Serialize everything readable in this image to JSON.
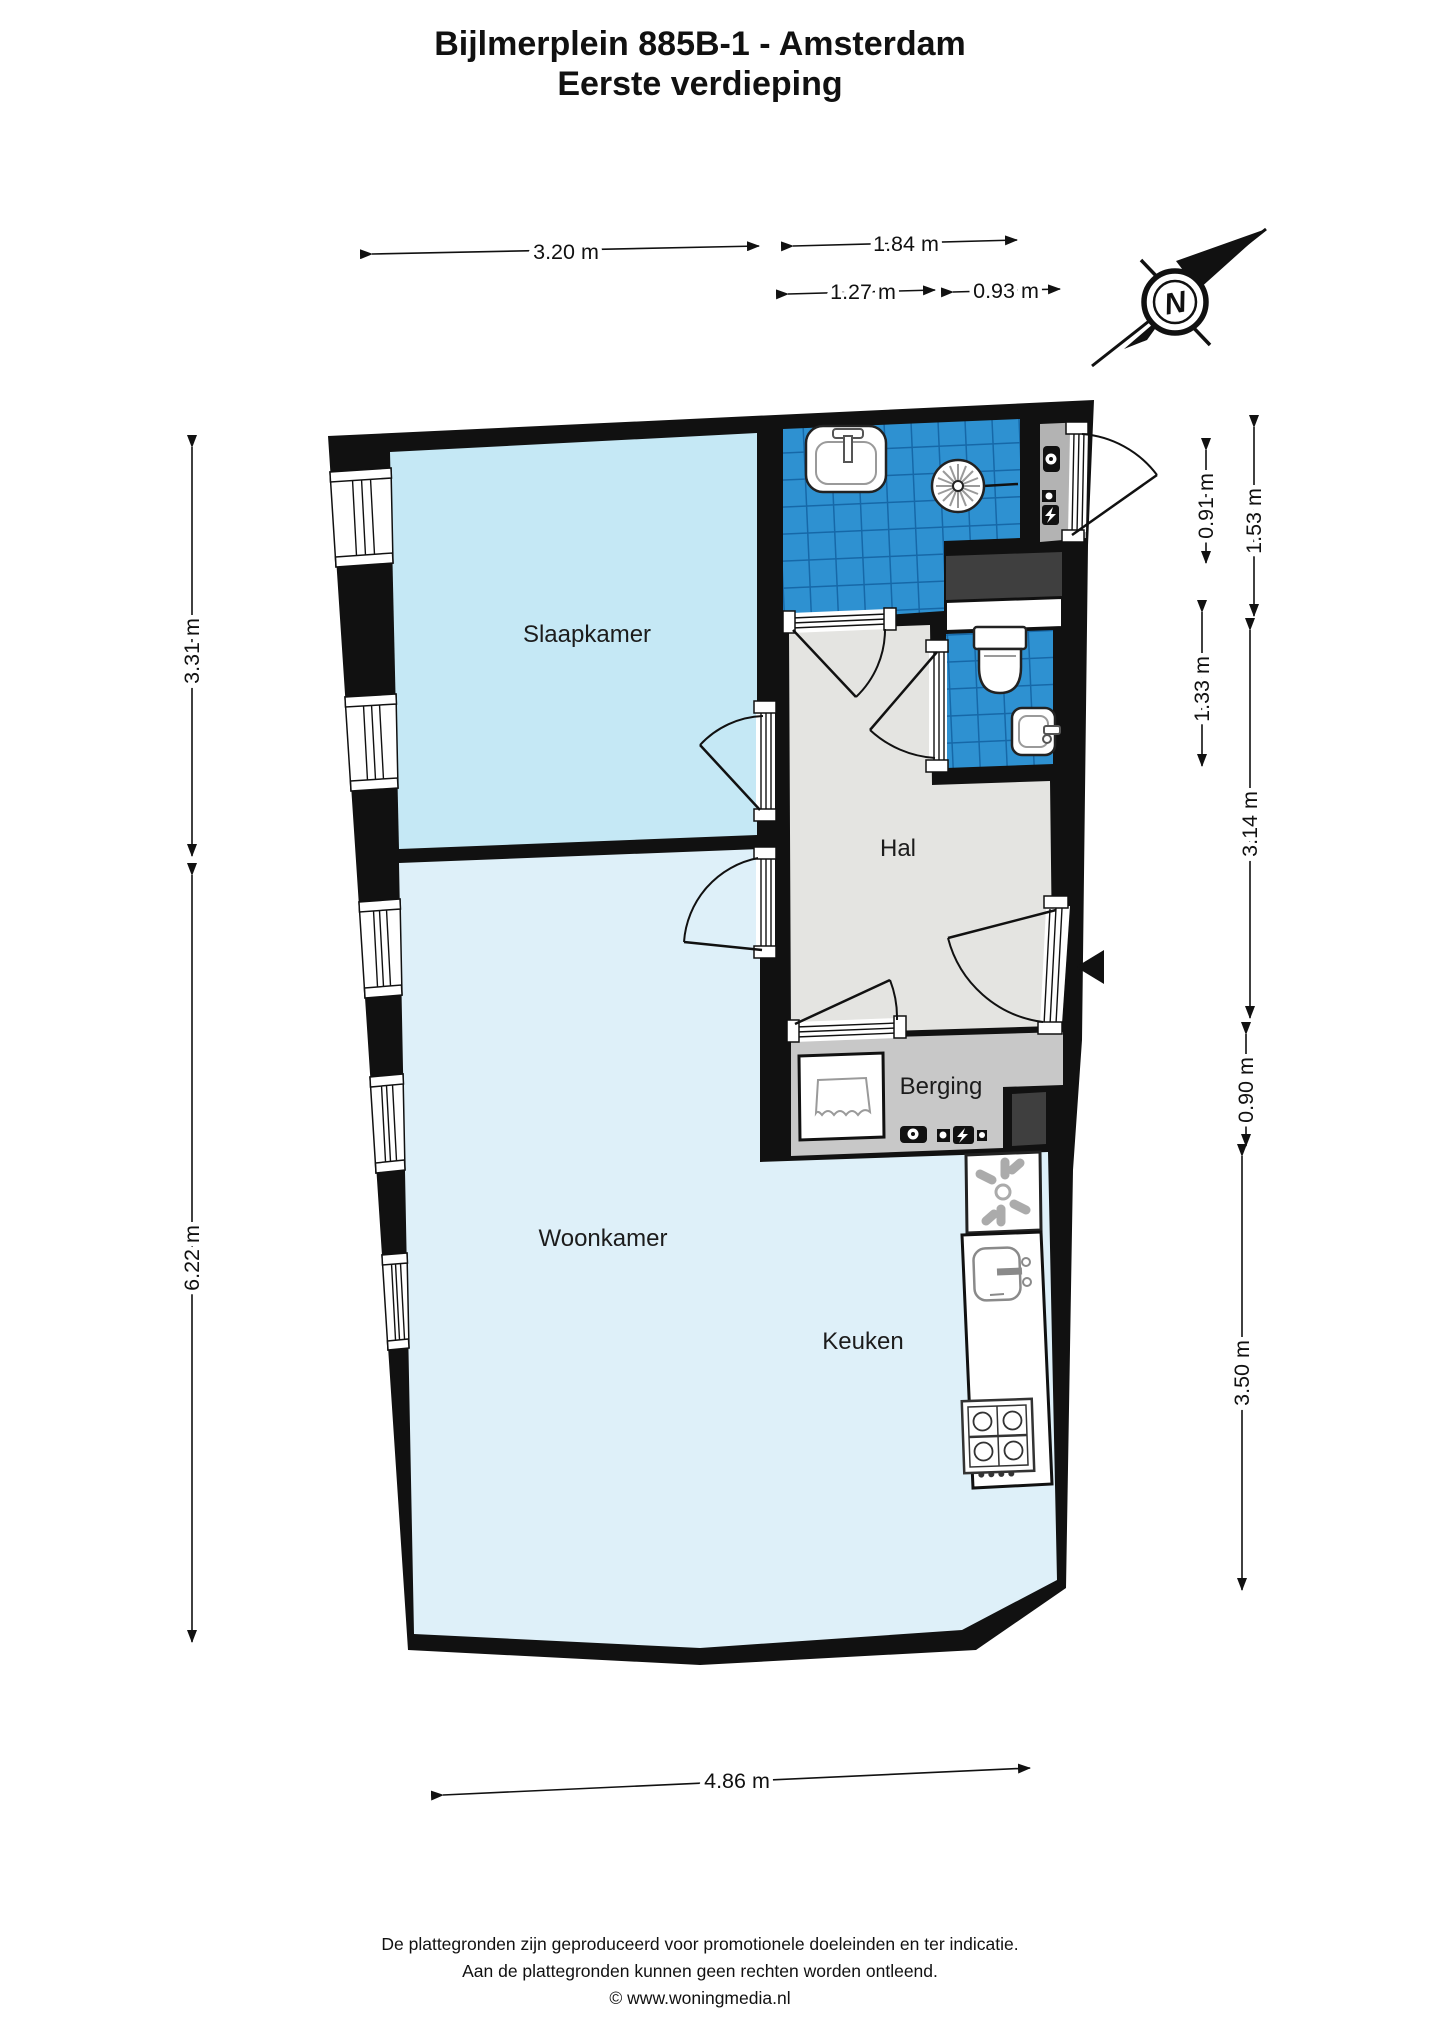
{
  "title": {
    "line1": "Bijlmerplein 885B-1 - Amsterdam",
    "line2": "Eerste verdieping"
  },
  "rooms": {
    "slaapkamer": "Slaapkamer",
    "woonkamer": "Woonkamer",
    "keuken": "Keuken",
    "hal": "Hal",
    "berging": "Berging"
  },
  "dimensions": {
    "top_1": "3.20 m",
    "top_2": "1.84 m",
    "top_3": "1.27 m",
    "top_4": "0.93 m",
    "left_1": "3.31 m",
    "left_2": "6.22 m",
    "right_inner_1": "0.91 m",
    "right_inner_2": "1.33 m",
    "right_outer_1": "1.53 m",
    "right_outer_2": "3.14 m",
    "right_outer_3": "0.90 m",
    "right_outer_4": "3.50 m",
    "bottom_1": "4.86 m"
  },
  "compass": {
    "label": "N"
  },
  "footer": {
    "line1": "De plattegronden zijn geproduceerd voor promotionele doeleinden en ter indicatie.",
    "line2": "Aan de plattegronden kunnen geen rechten worden ontleend.",
    "line3": "© www.woningmedia.nl"
  },
  "colors": {
    "wall": "#111111",
    "slaapkamer_floor": "#c5e8f5",
    "woonkamer_floor": "#def0f9",
    "hal_floor": "#e4e4e1",
    "berging_floor": "#c8c8c8",
    "meterkast_floor": "#b3b3b3",
    "tile_blue": "#2e91d1",
    "tile_grout": "#1668a8",
    "shaft_dark": "#3f3f3f"
  }
}
